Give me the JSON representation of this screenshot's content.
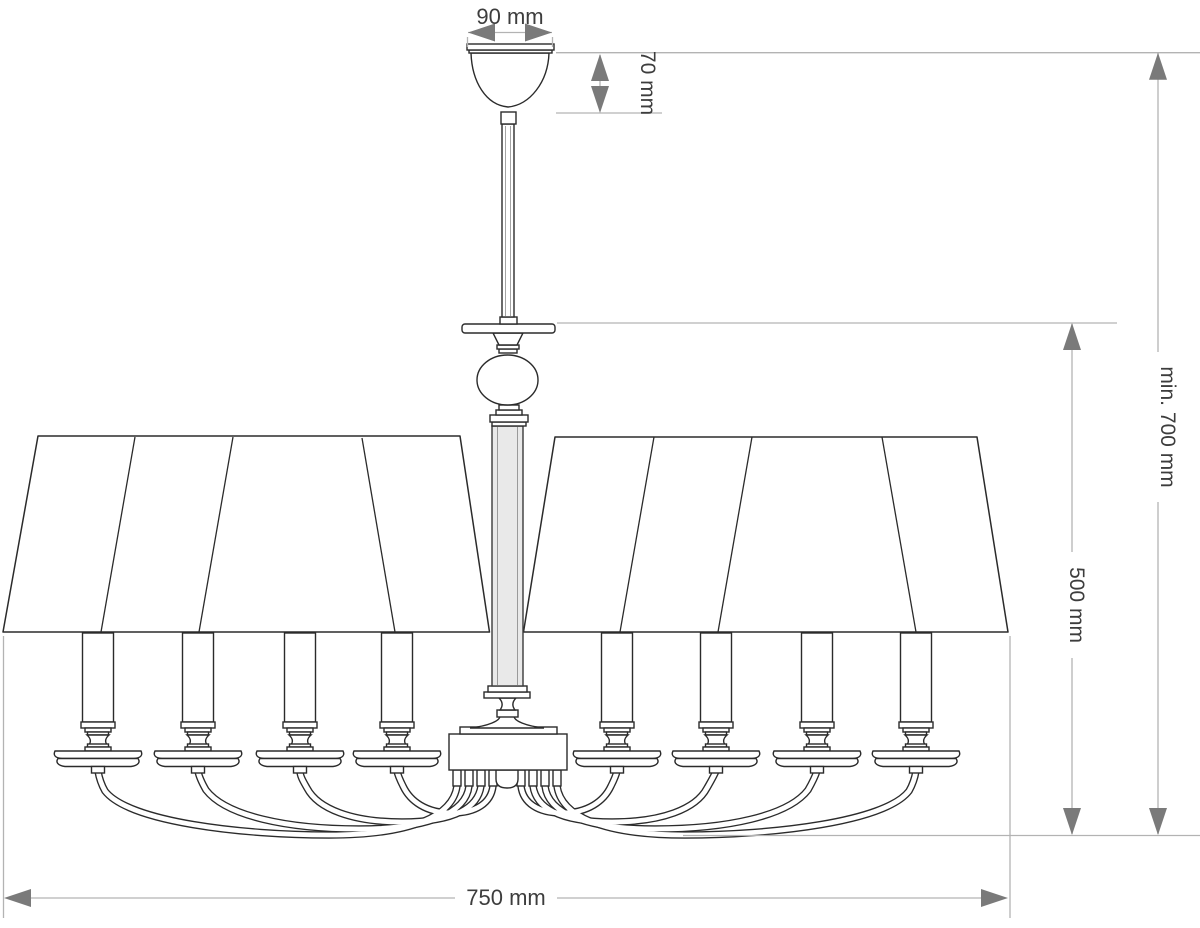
{
  "drawing": {
    "type": "technical dimension drawing",
    "subject": "eight-arm chandelier with pleated empire shade, front elevation",
    "units": "mm"
  },
  "labels": {
    "canopy_width": "90 mm",
    "canopy_height": "70 mm",
    "min_hanging_height": "min. 700 mm",
    "body_height": "500 mm",
    "diameter": "750 mm"
  },
  "counts": {
    "visible_candles": 8,
    "arms": 8,
    "shade_panel_seams": 8
  },
  "colors": {
    "background": "#ffffff",
    "outline": "#2b2b2b",
    "dimension_line": "#b3b3b3",
    "arrowhead": "#7a7a7a",
    "label_text": "#3d3d3d",
    "column_fill": "#e9e9e9"
  }
}
